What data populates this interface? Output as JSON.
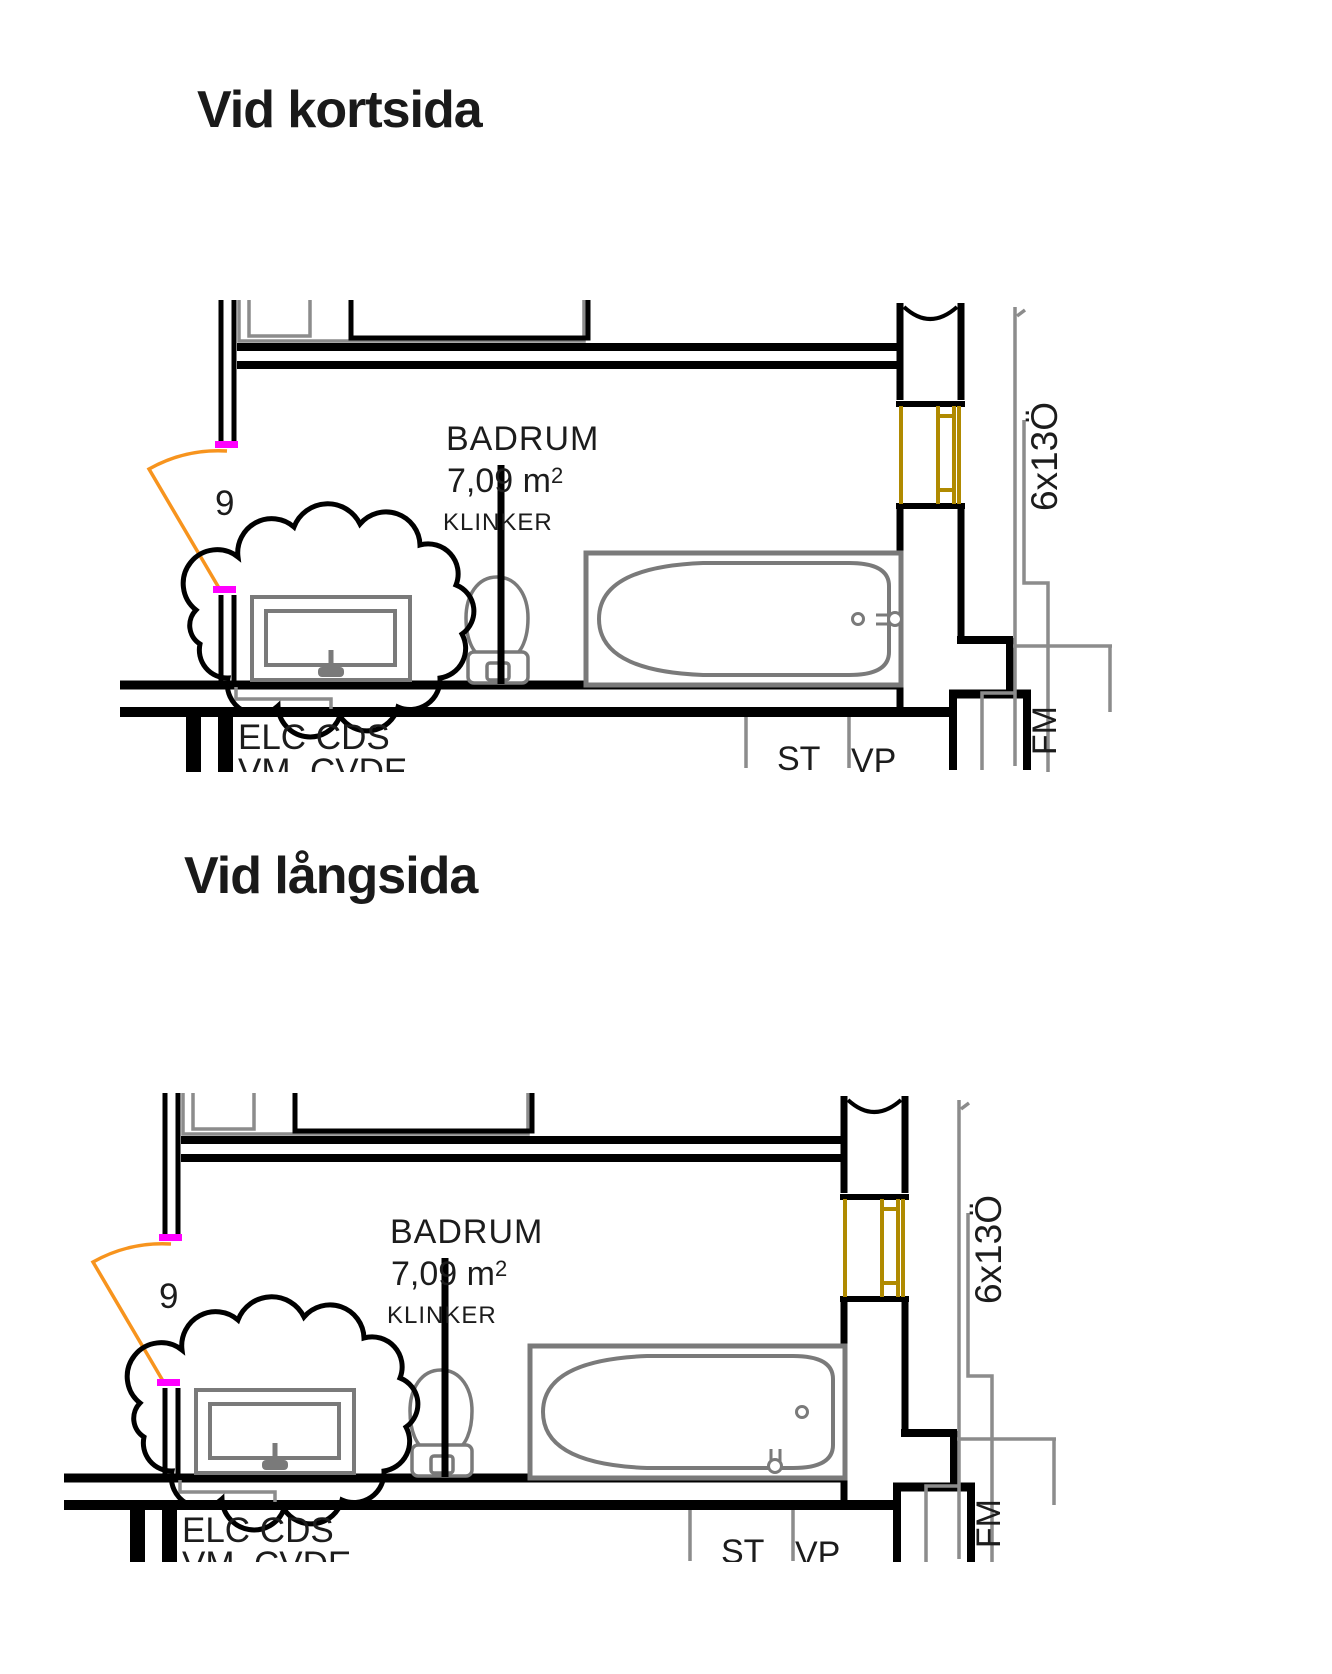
{
  "colors": {
    "wall": "#000000",
    "fixture_gray": "#7a7a7a",
    "reference_gray": "#8c8c8c",
    "door_arc_orange": "#f7941e",
    "door_seal_magenta": "#ff00ff",
    "window_frame_gold": "#b08a00",
    "text": "#1c1c1c"
  },
  "sections": [
    {
      "title": "Vid kortsida",
      "room": {
        "name": "BADRUM",
        "area": "7,09 m",
        "area_sup": "2",
        "flooring": "KLINKER"
      },
      "door_number": "9",
      "window_size": "6x13Ö",
      "labels": {
        "installations": "ELC CDS",
        "installations2": "VM  CVDE",
        "shaft_st": "ST",
        "shaft_vp": "VP",
        "fm": "FM"
      }
    },
    {
      "title": "Vid långsida",
      "room": {
        "name": "BADRUM",
        "area": "7,09 m",
        "area_sup": "2",
        "flooring": "KLINKER"
      },
      "door_number": "9",
      "window_size": "6x13Ö",
      "labels": {
        "installations": "ELC CDS",
        "installations2": "VM  CVDE",
        "shaft_st": "ST",
        "shaft_vp": "VP",
        "fm": "FM"
      }
    }
  ]
}
